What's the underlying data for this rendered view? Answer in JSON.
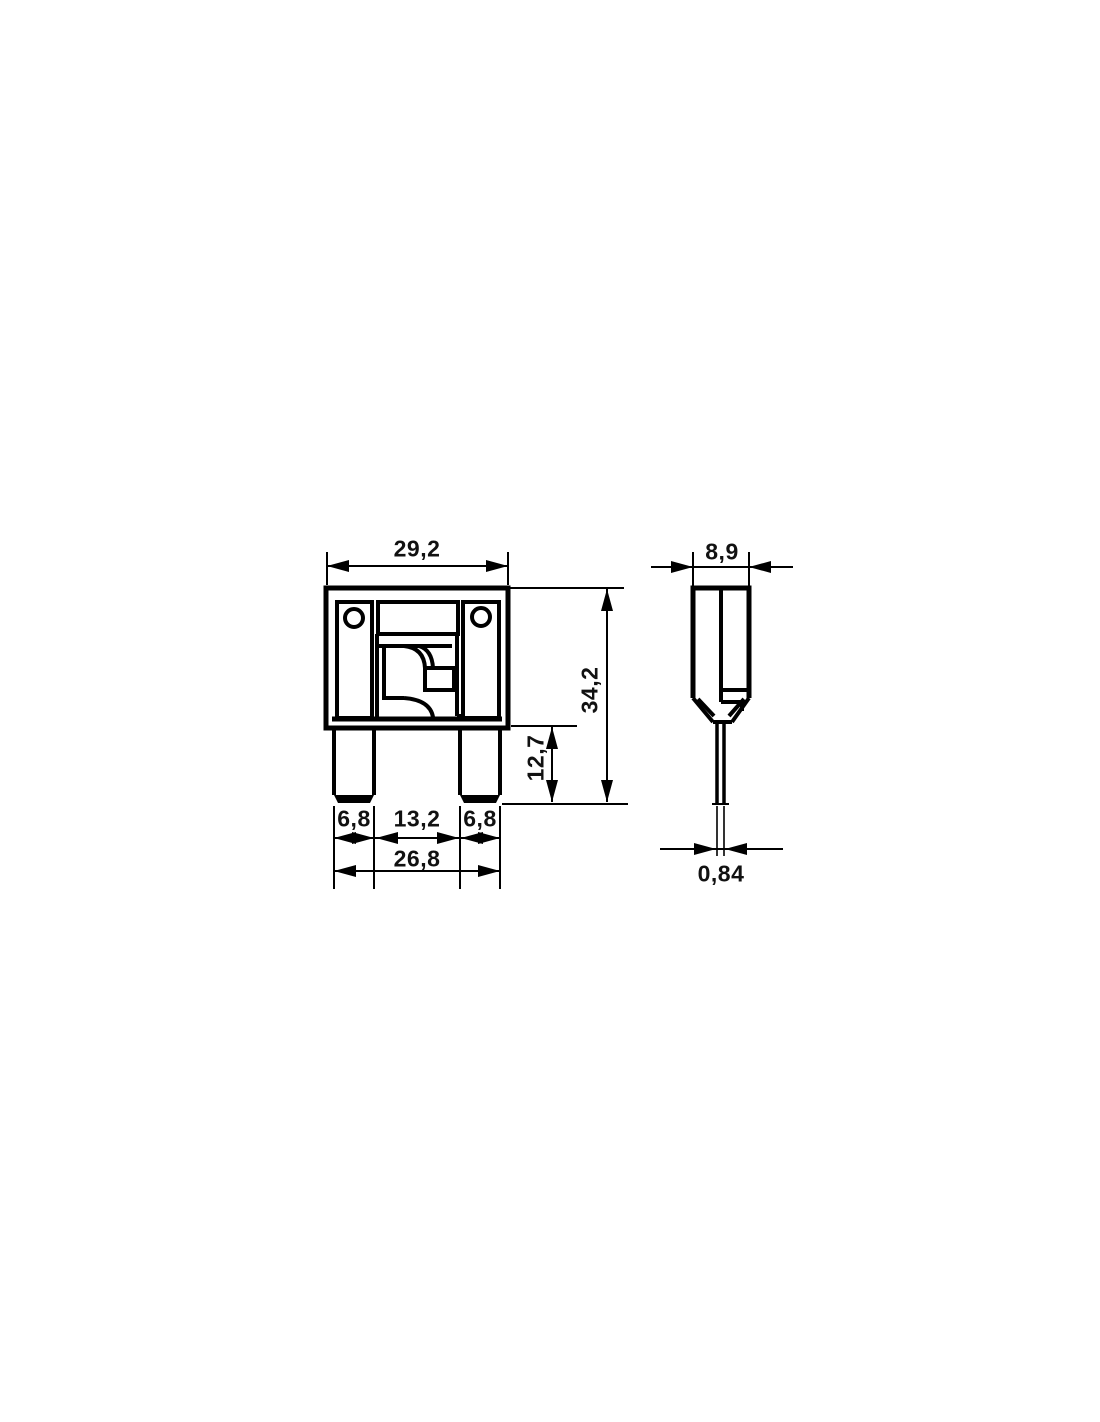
{
  "background": "#ffffff",
  "line_color": "#000000",
  "front_view": {
    "dims": {
      "body_width": "29,2",
      "total_height": "34,2",
      "terminal_height": "12,7",
      "terminal_width_left": "6,8",
      "terminal_gap": "13,2",
      "terminal_width_right": "6,8",
      "terminal_span": "26,8"
    }
  },
  "side_view": {
    "dims": {
      "body_depth": "8,9",
      "blade_thickness": "0,84"
    }
  }
}
